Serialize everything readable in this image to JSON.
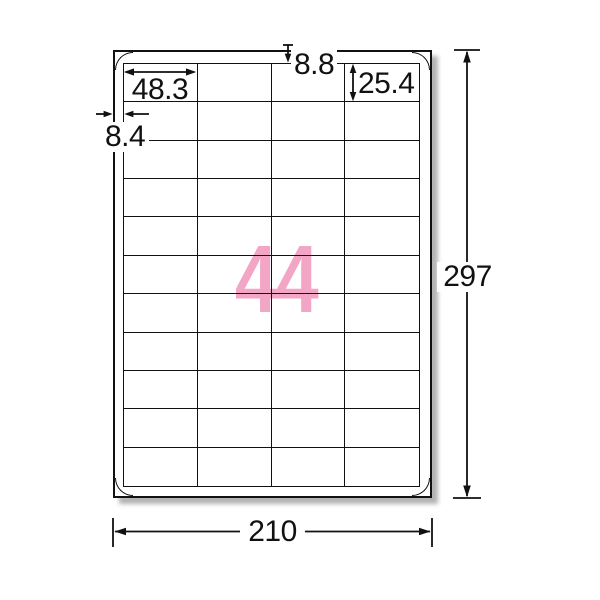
{
  "diagram": {
    "label_count": "44",
    "accent_color": "#F2A5C5",
    "line_color": "#111111",
    "sheet": {
      "columns": 4,
      "rows": 11,
      "total_labels": 44
    },
    "dimensions_mm": {
      "label_width": "48.3",
      "top_margin": "8.8",
      "label_height": "25.4",
      "side_margin": "8.4",
      "paper_width": "210",
      "paper_height": "297"
    }
  }
}
